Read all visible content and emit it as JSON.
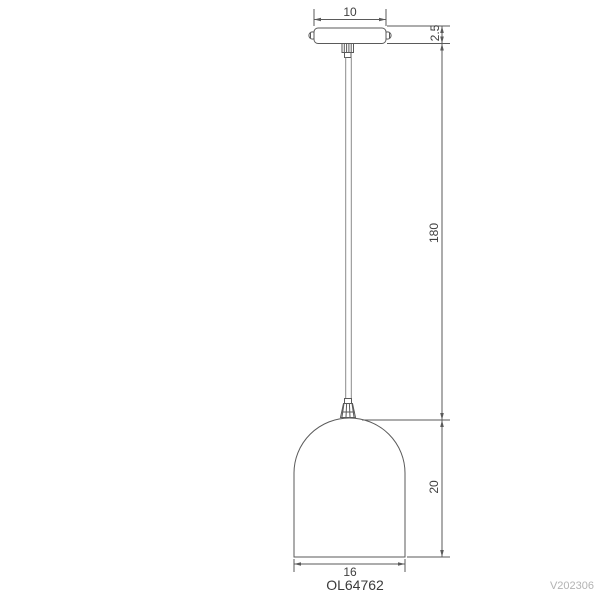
{
  "drawing": {
    "product_code": "OL64762",
    "version_code": "V202306",
    "dimensions": {
      "canopy_width": "10",
      "canopy_thickness": "2.5",
      "drop_length": "180",
      "shade_height": "20",
      "shade_diameter": "16"
    },
    "colors": {
      "outline": "#5a5a5a",
      "cord": "#8a8a8a",
      "dimension_text": "#3f3f3f",
      "watermark": "#b3b3b3",
      "background": "#ffffff"
    }
  }
}
